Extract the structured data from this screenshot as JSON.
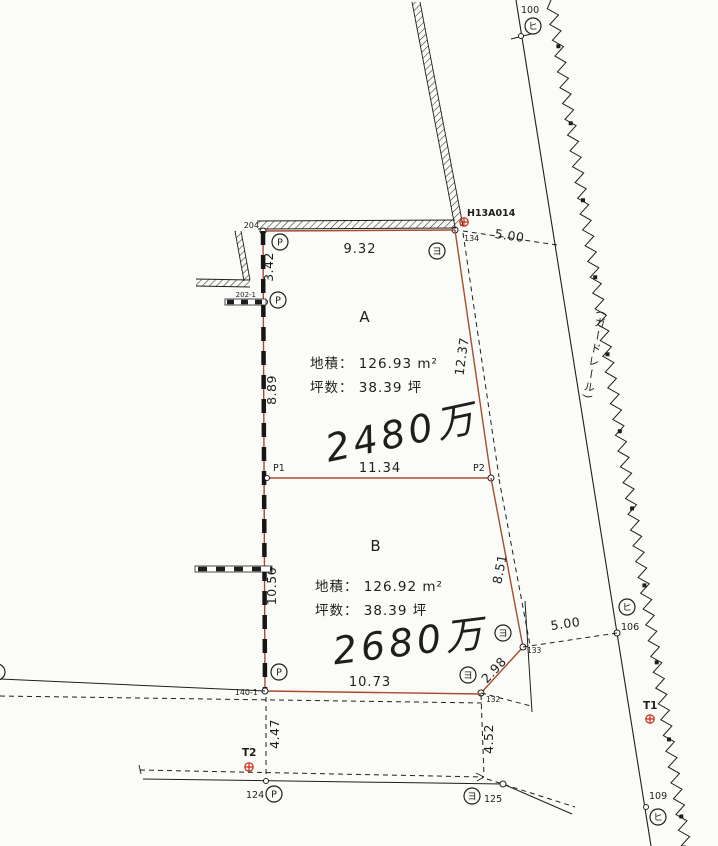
{
  "parcels": {
    "a": {
      "name": "A",
      "area": "地積：  126.93 m²",
      "tsubo": "坪数：  38.39 坪",
      "price": "2480万"
    },
    "b": {
      "name": "B",
      "area": "地積：  126.92 m²",
      "tsubo": "坪数：  38.39 坪",
      "price": "2680万"
    }
  },
  "dims": {
    "top_edge": "9.32",
    "top_offset": "5.00",
    "left_upper": "3.42",
    "left_mid": "8.89",
    "left_lower": "10.56",
    "a_right": "12.37",
    "divider": "11.34",
    "b_right": "8.51",
    "b_cut": "2.98",
    "right_offset": "5.00",
    "bottom_edge": "10.73",
    "ext_left": "4.47",
    "ext_mid": "4.52"
  },
  "points": {
    "p1": "P1",
    "p2": "P2",
    "pt100": "100",
    "pt106": "106",
    "pt109": "109",
    "pt124": "124",
    "pt125": "125",
    "pt132": "132",
    "pt133": "133",
    "pt134": "134",
    "pt204": "204",
    "pt202": "202-1",
    "pt140": "140-1",
    "bench": "H13A014",
    "t1": "T1",
    "t2": "T2"
  },
  "marks": {
    "p": "P",
    "yo": "ヨ",
    "hi": "ヒ"
  },
  "road": {
    "guardrail": "(ガードレール)"
  },
  "colors": {
    "boundary": "#a84c30",
    "red": "#cf2a18",
    "pencil": "#8f8f8f",
    "ink": "#1e1e1e",
    "paper": "#fbfbf8"
  }
}
